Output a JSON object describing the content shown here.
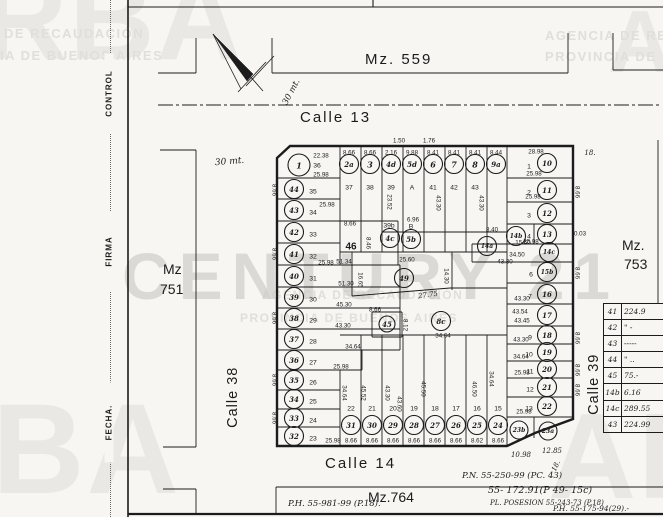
{
  "form": {
    "labels": [
      "CONTROL",
      "FIRMA",
      "FECHA."
    ]
  },
  "watermarks": {
    "big": [
      "RBA",
      "BA",
      "AR",
      "A"
    ],
    "caps": [
      "DE RECAUDACIÓN",
      "IA DE BUENOS AIRES",
      "AGENCIA DE RE",
      "PROVINCIA DE",
      "AGENCIA DE RECAUDACIÓN",
      "PROVINCIA DE BUENOS AIRES"
    ],
    "century": "CENTURY 21"
  },
  "areas": {
    "mz559": "Mz. 559",
    "mz751_l1": "Mz",
    "mz751_l2": "751",
    "mz753_l1": "Mz.",
    "mz753_l2": "753",
    "mz764": "Mz.764"
  },
  "streets": {
    "calle13": "Calle 13",
    "calle14": "Calle 14",
    "calle38": "Calle 38",
    "calle39": "Calle 39"
  },
  "north_arrow_label": "30 mt.",
  "scale_note": "30 mt.",
  "annotations": {
    "pn": "P.N. 55-250-99 (PC. 43)",
    "a1": "55- 172.91(P 49- 15c)",
    "a2": "PL. POSESION 55-243-73 (P.18)",
    "a3": "P.H. 55-175-94(29).-",
    "a4": "P.H. 55-981-99 (P.18)."
  },
  "table": {
    "rows": [
      {
        "id": "41",
        "val": "224.9"
      },
      {
        "id": "42",
        "val": "\" -"
      },
      {
        "id": "43",
        "val": "-----"
      },
      {
        "id": "44",
        "val": "\" .."
      },
      {
        "id": "45",
        "val": "75.-"
      },
      {
        "id": "14b",
        "val": "6.16"
      },
      {
        "id": "14c",
        "val": "289.55"
      },
      {
        "id": "43",
        "val": "224.99"
      }
    ]
  },
  "map": {
    "parcels": [
      {
        "id": "1",
        "x": 299,
        "y": 165,
        "r": 11
      },
      {
        "id": "44",
        "x": 294,
        "y": 189
      },
      {
        "id": "43",
        "x": 294,
        "y": 210
      },
      {
        "id": "42",
        "x": 294,
        "y": 232
      },
      {
        "id": "41",
        "x": 294,
        "y": 254
      },
      {
        "id": "40",
        "x": 294,
        "y": 276
      },
      {
        "id": "39",
        "x": 294,
        "y": 297
      },
      {
        "id": "38",
        "x": 294,
        "y": 318
      },
      {
        "id": "37",
        "x": 294,
        "y": 339
      },
      {
        "id": "36",
        "x": 294,
        "y": 360
      },
      {
        "id": "35",
        "x": 294,
        "y": 380
      },
      {
        "id": "34",
        "x": 294,
        "y": 399
      },
      {
        "id": "33",
        "x": 294,
        "y": 418
      },
      {
        "id": "32",
        "x": 294,
        "y": 436
      },
      {
        "id": "2a",
        "x": 349,
        "y": 164
      },
      {
        "id": "3",
        "x": 370,
        "y": 164
      },
      {
        "id": "4d",
        "x": 391,
        "y": 164
      },
      {
        "id": "5d",
        "x": 412,
        "y": 164
      },
      {
        "id": "6",
        "x": 433,
        "y": 164
      },
      {
        "id": "7",
        "x": 454,
        "y": 164
      },
      {
        "id": "8",
        "x": 475,
        "y": 164
      },
      {
        "id": "9a",
        "x": 496,
        "y": 164
      },
      {
        "id": "10",
        "x": 547,
        "y": 163
      },
      {
        "id": "11",
        "x": 547,
        "y": 190
      },
      {
        "id": "12",
        "x": 547,
        "y": 213
      },
      {
        "id": "13",
        "x": 547,
        "y": 234
      },
      {
        "id": "14b",
        "x": 516,
        "y": 236
      },
      {
        "id": "14a",
        "x": 487,
        "y": 246
      },
      {
        "id": "14c",
        "x": 549,
        "y": 252
      },
      {
        "id": "15b",
        "x": 547,
        "y": 272
      },
      {
        "id": "16",
        "x": 547,
        "y": 294
      },
      {
        "id": "17",
        "x": 547,
        "y": 315
      },
      {
        "id": "18",
        "x": 547,
        "y": 335
      },
      {
        "id": "19",
        "x": 547,
        "y": 352
      },
      {
        "id": "20",
        "x": 547,
        "y": 369
      },
      {
        "id": "21",
        "x": 547,
        "y": 387
      },
      {
        "id": "22",
        "x": 547,
        "y": 406
      },
      {
        "id": "23b",
        "x": 519,
        "y": 430,
        "r": 9
      },
      {
        "id": "23a",
        "x": 548,
        "y": 431,
        "r": 9
      },
      {
        "id": "31",
        "x": 351,
        "y": 425
      },
      {
        "id": "30",
        "x": 372,
        "y": 425
      },
      {
        "id": "29",
        "x": 393,
        "y": 425
      },
      {
        "id": "28",
        "x": 414,
        "y": 425
      },
      {
        "id": "27",
        "x": 435,
        "y": 425
      },
      {
        "id": "26",
        "x": 456,
        "y": 425
      },
      {
        "id": "25",
        "x": 477,
        "y": 425
      },
      {
        "id": "24",
        "x": 498,
        "y": 425
      },
      {
        "id": "4c",
        "x": 390,
        "y": 238
      },
      {
        "id": "5b",
        "x": 411,
        "y": 239
      },
      {
        "id": "49",
        "x": 404,
        "y": 278
      },
      {
        "id": "45",
        "x": 387,
        "y": 324,
        "r": 8
      },
      {
        "id": "8c",
        "x": 441,
        "y": 321
      }
    ],
    "lots": [
      {
        "t": "36",
        "x": 317,
        "y": 166
      },
      {
        "t": "35",
        "x": 313,
        "y": 192
      },
      {
        "t": "34",
        "x": 313,
        "y": 213
      },
      {
        "t": "33",
        "x": 313,
        "y": 235
      },
      {
        "t": "32",
        "x": 313,
        "y": 257
      },
      {
        "t": "31",
        "x": 313,
        "y": 279
      },
      {
        "t": "30",
        "x": 313,
        "y": 300
      },
      {
        "t": "29",
        "x": 313,
        "y": 321
      },
      {
        "t": "28",
        "x": 313,
        "y": 342
      },
      {
        "t": "27",
        "x": 313,
        "y": 363
      },
      {
        "t": "26",
        "x": 313,
        "y": 383
      },
      {
        "t": "25",
        "x": 313,
        "y": 402
      },
      {
        "t": "24",
        "x": 313,
        "y": 421
      },
      {
        "t": "23",
        "x": 313,
        "y": 439
      },
      {
        "t": "37",
        "x": 349,
        "y": 188
      },
      {
        "t": "38",
        "x": 370,
        "y": 188
      },
      {
        "t": "39",
        "x": 391,
        "y": 188
      },
      {
        "t": "A",
        "x": 412,
        "y": 188
      },
      {
        "t": "41",
        "x": 433,
        "y": 188
      },
      {
        "t": "42",
        "x": 454,
        "y": 188
      },
      {
        "t": "43",
        "x": 475,
        "y": 188
      },
      {
        "t": "1",
        "x": 529,
        "y": 167
      },
      {
        "t": "2",
        "x": 529,
        "y": 193
      },
      {
        "t": "3",
        "x": 529,
        "y": 216
      },
      {
        "t": "4",
        "x": 529,
        "y": 237
      },
      {
        "t": "6",
        "x": 531,
        "y": 275
      },
      {
        "t": "7",
        "x": 530,
        "y": 297
      },
      {
        "t": "9",
        "x": 530,
        "y": 338
      },
      {
        "t": "10",
        "x": 529,
        "y": 355
      },
      {
        "t": "11",
        "x": 530,
        "y": 372
      },
      {
        "t": "12",
        "x": 530,
        "y": 390
      },
      {
        "t": "13",
        "x": 529,
        "y": 409
      },
      {
        "t": "22",
        "x": 351,
        "y": 409
      },
      {
        "t": "21",
        "x": 372,
        "y": 409
      },
      {
        "t": "20",
        "x": 393,
        "y": 409
      },
      {
        "t": "19",
        "x": 414,
        "y": 409
      },
      {
        "t": "18",
        "x": 435,
        "y": 409
      },
      {
        "t": "17",
        "x": 456,
        "y": 409
      },
      {
        "t": "16",
        "x": 477,
        "y": 409
      },
      {
        "t": "15",
        "x": 498,
        "y": 409
      },
      {
        "t": "39b",
        "x": 389,
        "y": 226
      },
      {
        "t": "B",
        "x": 411,
        "y": 227
      },
      {
        "t": "46",
        "x": 351,
        "y": 247,
        "s": 10,
        "b": 1
      }
    ],
    "meas": [
      {
        "t": "1.50",
        "x": 399,
        "y": 141
      },
      {
        "t": "1.76",
        "x": 429,
        "y": 141
      },
      {
        "t": "8.66",
        "x": 349,
        "y": 153
      },
      {
        "t": "8.66",
        "x": 370,
        "y": 153
      },
      {
        "t": "2.16",
        "x": 391,
        "y": 153
      },
      {
        "t": "9.88",
        "x": 412,
        "y": 153
      },
      {
        "t": "8.41",
        "x": 433,
        "y": 153
      },
      {
        "t": "8.41",
        "x": 454,
        "y": 153
      },
      {
        "t": "8.41",
        "x": 475,
        "y": 153
      },
      {
        "t": "8.44",
        "x": 496,
        "y": 153
      },
      {
        "t": "22.38",
        "x": 321,
        "y": 156
      },
      {
        "t": "25.98",
        "x": 321,
        "y": 175
      },
      {
        "t": "25.98",
        "x": 327,
        "y": 205
      },
      {
        "t": "25.98",
        "x": 326,
        "y": 263
      },
      {
        "t": "51.34",
        "x": 344,
        "y": 262
      },
      {
        "t": "51.30",
        "x": 346,
        "y": 284
      },
      {
        "t": "45.30",
        "x": 344,
        "y": 305
      },
      {
        "t": "43.30",
        "x": 343,
        "y": 326
      },
      {
        "t": "34.64",
        "x": 353,
        "y": 347
      },
      {
        "t": "25.98",
        "x": 341,
        "y": 367
      },
      {
        "t": "8.66",
        "x": 350,
        "y": 224
      },
      {
        "t": "8.46",
        "x": 368,
        "y": 243,
        "rot": 90
      },
      {
        "t": "6.96",
        "x": 413,
        "y": 220
      },
      {
        "t": "25.60",
        "x": 407,
        "y": 260
      },
      {
        "t": "16.65",
        "x": 360,
        "y": 280,
        "rot": 90
      },
      {
        "t": "14.30",
        "x": 446,
        "y": 276,
        "rot": 90
      },
      {
        "t": "27.75",
        "x": 428,
        "y": 295,
        "rot": -8,
        "hw": 1
      },
      {
        "t": "8.66",
        "x": 375,
        "y": 310
      },
      {
        "t": "8.12",
        "x": 405,
        "y": 325,
        "rot": 90
      },
      {
        "t": "34.64",
        "x": 443,
        "y": 336
      },
      {
        "t": "34.64",
        "x": 344,
        "y": 393,
        "rot": 90
      },
      {
        "t": "45.52",
        "x": 363,
        "y": 393,
        "rot": 90
      },
      {
        "t": "43.30",
        "x": 387,
        "y": 393,
        "rot": 90
      },
      {
        "t": "43.60",
        "x": 399,
        "y": 404,
        "rot": 90
      },
      {
        "t": "45.50",
        "x": 423,
        "y": 389,
        "rot": 90
      },
      {
        "t": "46.50",
        "x": 474,
        "y": 389,
        "rot": 90
      },
      {
        "t": "34.64",
        "x": 491,
        "y": 379,
        "rot": 90
      },
      {
        "t": "25.98",
        "x": 333,
        "y": 441
      },
      {
        "t": "8.66",
        "x": 351,
        "y": 441
      },
      {
        "t": "8.66",
        "x": 372,
        "y": 441
      },
      {
        "t": "8.66",
        "x": 393,
        "y": 441
      },
      {
        "t": "8.66",
        "x": 414,
        "y": 441
      },
      {
        "t": "8.66",
        "x": 435,
        "y": 441
      },
      {
        "t": "8.66",
        "x": 456,
        "y": 441
      },
      {
        "t": "8.62",
        "x": 477,
        "y": 441
      },
      {
        "t": "8.66",
        "x": 498,
        "y": 441
      },
      {
        "t": "28.98",
        "x": 536,
        "y": 152
      },
      {
        "t": "25.98",
        "x": 534,
        "y": 174
      },
      {
        "t": "25.98",
        "x": 533,
        "y": 197
      },
      {
        "t": "25.98",
        "x": 531,
        "y": 242
      },
      {
        "t": "8.40",
        "x": 492,
        "y": 230
      },
      {
        "t": "15.60",
        "x": 523,
        "y": 243
      },
      {
        "t": "34.50",
        "x": 517,
        "y": 255
      },
      {
        "t": "43.30",
        "x": 505,
        "y": 262
      },
      {
        "t": "43.30",
        "x": 522,
        "y": 299
      },
      {
        "t": "43.54",
        "x": 520,
        "y": 312
      },
      {
        "t": "43.45",
        "x": 522,
        "y": 321
      },
      {
        "t": "43.30",
        "x": 521,
        "y": 340
      },
      {
        "t": "34.64",
        "x": 521,
        "y": 357
      },
      {
        "t": "25.98",
        "x": 522,
        "y": 373
      },
      {
        "t": "25.98",
        "x": 524,
        "y": 412
      },
      {
        "t": "10.98",
        "x": 521,
        "y": 455,
        "hw": 1
      },
      {
        "t": "12.85",
        "x": 552,
        "y": 451,
        "hw": 1
      },
      {
        "t": "8.66",
        "x": 274,
        "y": 190,
        "rot": 90
      },
      {
        "t": "8.66",
        "x": 274,
        "y": 254,
        "rot": 90
      },
      {
        "t": "8.66",
        "x": 274,
        "y": 318,
        "rot": 90
      },
      {
        "t": "8.66",
        "x": 274,
        "y": 380,
        "rot": 90
      },
      {
        "t": "8.66",
        "x": 274,
        "y": 418,
        "rot": 90
      },
      {
        "t": "8.66",
        "x": 577,
        "y": 192,
        "rot": 90
      },
      {
        "t": "8.66",
        "x": 577,
        "y": 273,
        "rot": 90
      },
      {
        "t": "8.66",
        "x": 577,
        "y": 338,
        "rot": 90
      },
      {
        "t": "8.66",
        "x": 577,
        "y": 370,
        "rot": 90
      },
      {
        "t": "8.66",
        "x": 577,
        "y": 390,
        "rot": 90
      },
      {
        "t": "23.52",
        "x": 389,
        "y": 202,
        "rot": 90
      },
      {
        "t": "43.30",
        "x": 438,
        "y": 203,
        "rot": 90
      },
      {
        "t": "43.30",
        "x": 481,
        "y": 203,
        "rot": 90
      },
      {
        "t": "0.03",
        "x": 580,
        "y": 234
      },
      {
        "t": "18.",
        "x": 590,
        "y": 153,
        "hw": 1
      },
      {
        "t": "18.",
        "x": 556,
        "y": 466,
        "rot": -65,
        "hw": 1
      }
    ]
  }
}
